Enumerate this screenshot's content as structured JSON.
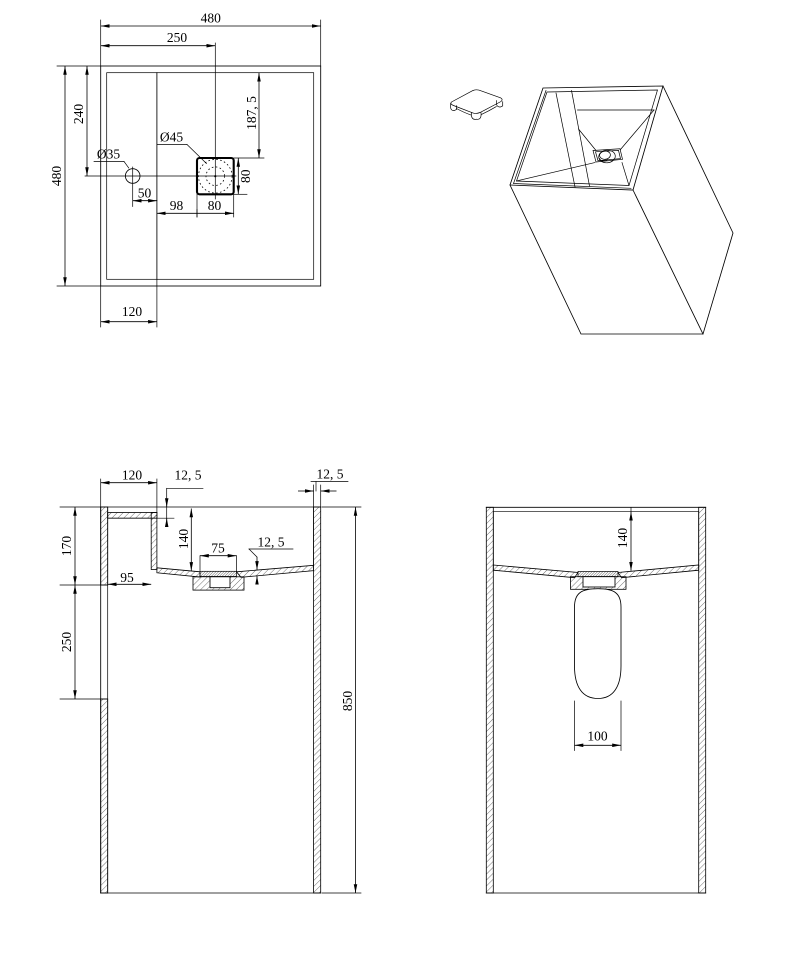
{
  "plan_view": {
    "overall_width": "480",
    "center_offset": "250",
    "top_to_center": "240",
    "overall_depth": "480",
    "drain_dia": "Ø45",
    "faucet_dia": "Ø35",
    "rim_to_drain": "187, 5",
    "drain_sq_v": "80",
    "faucet_offset": "50",
    "seg_98": "98",
    "drain_sq_h": "80",
    "channel_width": "120"
  },
  "front_section": {
    "channel_width": "120",
    "deck_thickness": "12, 5",
    "wall_thickness": "12, 5",
    "channel_depth": "170",
    "bowl_depth": "140",
    "drain_opening": "75",
    "bottom_thickness": "12, 5",
    "channel_inner": "95",
    "opening_height": "250",
    "overall_height": "850"
  },
  "side_section": {
    "bowl_depth": "140",
    "pipe_width": "100"
  }
}
